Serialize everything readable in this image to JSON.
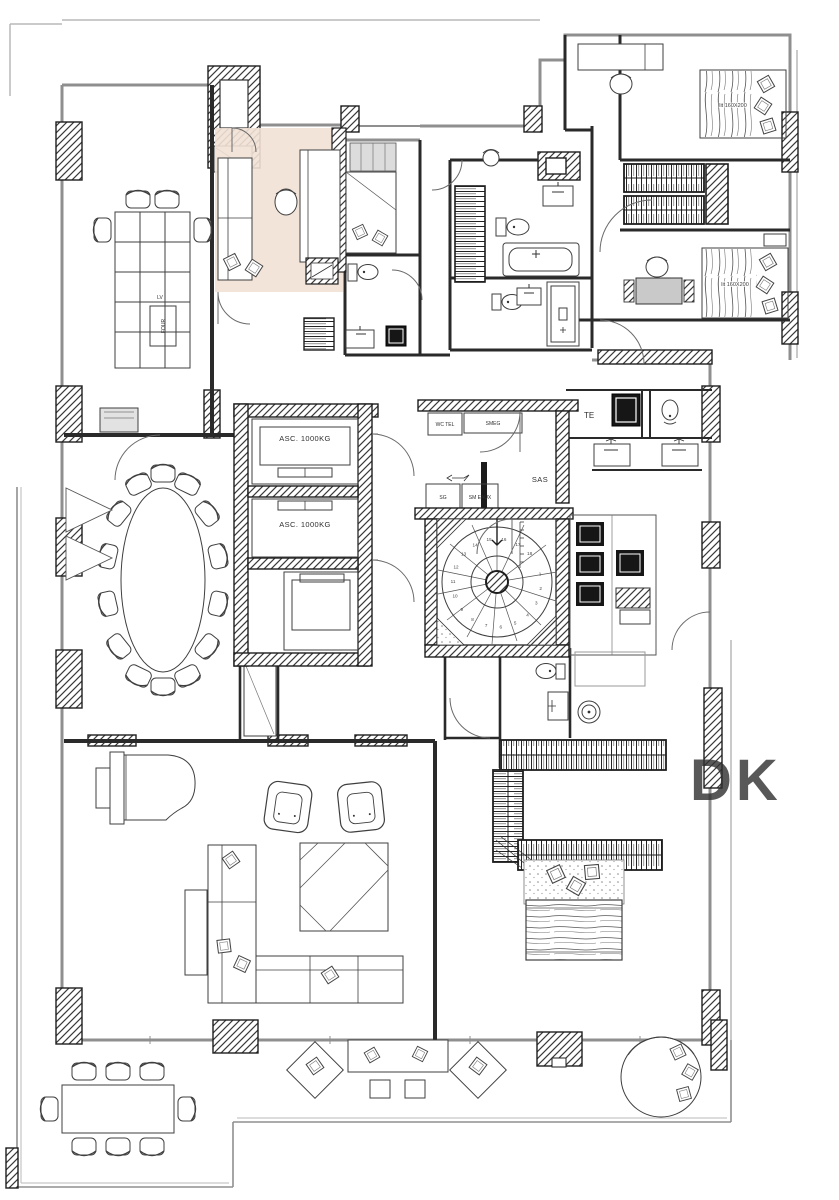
{
  "plan": {
    "labels": {
      "elevator_1": "ASC. 1000KG",
      "elevator_2": "ASC. 1000KG",
      "sas": "SAS",
      "te": "TE",
      "wc_tel": "WC TEL",
      "smeg": "SMEG",
      "sg": "SG",
      "sm_eaux": "SM EAUX",
      "lv": "LV",
      "four": "FOUR",
      "bed_1": "lit 160X200",
      "bed_2": "lit 160X200",
      "watermark": "DK"
    },
    "stair_step_numbers": [
      "1",
      "2",
      "3",
      "4",
      "5",
      "6",
      "7",
      "8",
      "9",
      "10",
      "11",
      "12",
      "13",
      "14",
      "15",
      "16",
      "17",
      "18"
    ],
    "meeting_chair_count": 14,
    "terrace_chair_count": 8,
    "colors": {
      "highlight_fill": "#f2e1d6",
      "wall": "#2a2a2a",
      "light_line": "#8f8f8f",
      "watermark": "#e7e1dc"
    }
  }
}
